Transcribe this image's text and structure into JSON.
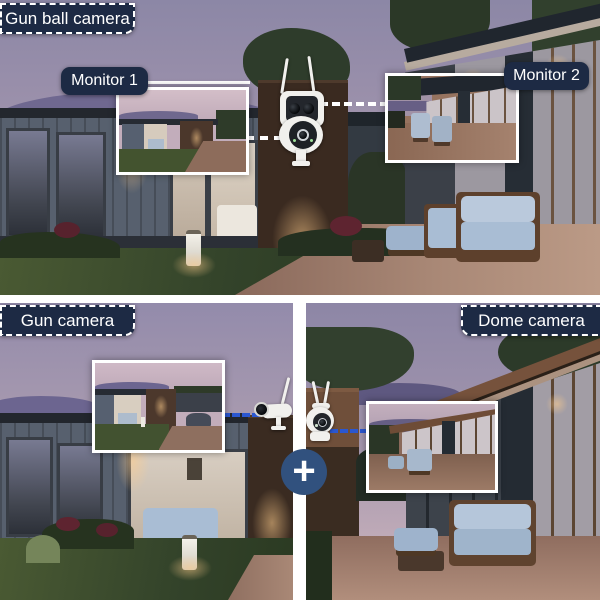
{
  "poster": {
    "top": {
      "tag": "Gun ball camera",
      "monitor1_label": "Monitor 1",
      "monitor2_label": "Monitor 2"
    },
    "bottom_left": {
      "tag": "Gun camera"
    },
    "bottom_right": {
      "tag": "Dome camera"
    },
    "plus_symbol": "+"
  },
  "icons": {
    "top_camera": "gun-ball-dual-camera-icon",
    "bottom_left_camera": "bullet-gun-camera-icon",
    "bottom_right_camera": "dome-ptz-camera-icon",
    "plus": "plus-icon"
  },
  "colors": {
    "label_bg": "#1d2a44",
    "label_text": "#ffffff",
    "label_dash_border": "#ffffff",
    "inset_border": "#ffffff",
    "divider": "#ffffff",
    "plus_badge_bg": "#31517e",
    "connector_top": "#ffffff",
    "connector_bottom": "#2b57d0"
  }
}
